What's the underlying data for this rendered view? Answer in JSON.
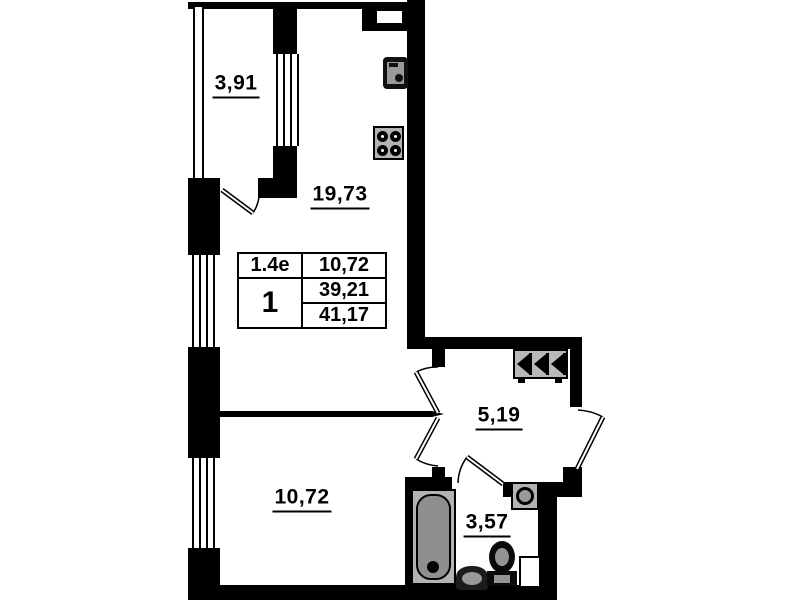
{
  "rooms": {
    "balcony": {
      "area": "3,91"
    },
    "kitchen_living": {
      "area": "19,73"
    },
    "bedroom": {
      "area": "10,72"
    },
    "hallway": {
      "area": "5,19"
    },
    "bathroom": {
      "area": "3,57"
    }
  },
  "unit_table": {
    "unit_type": "1.4e",
    "room_count": "1",
    "living_area": "10,72",
    "area_no_balcony": "39,21",
    "total_area": "41,17"
  },
  "fixtures": [
    "kitchen-sink-icon",
    "stove-icon",
    "wardrobe-icon",
    "bathtub-icon",
    "washbasin-icon",
    "toilet-icon",
    "washing-machine-icon"
  ],
  "colors": {
    "wall": "#000000",
    "fixture_gray": "#9a9a9a",
    "background": "#ffffff"
  }
}
